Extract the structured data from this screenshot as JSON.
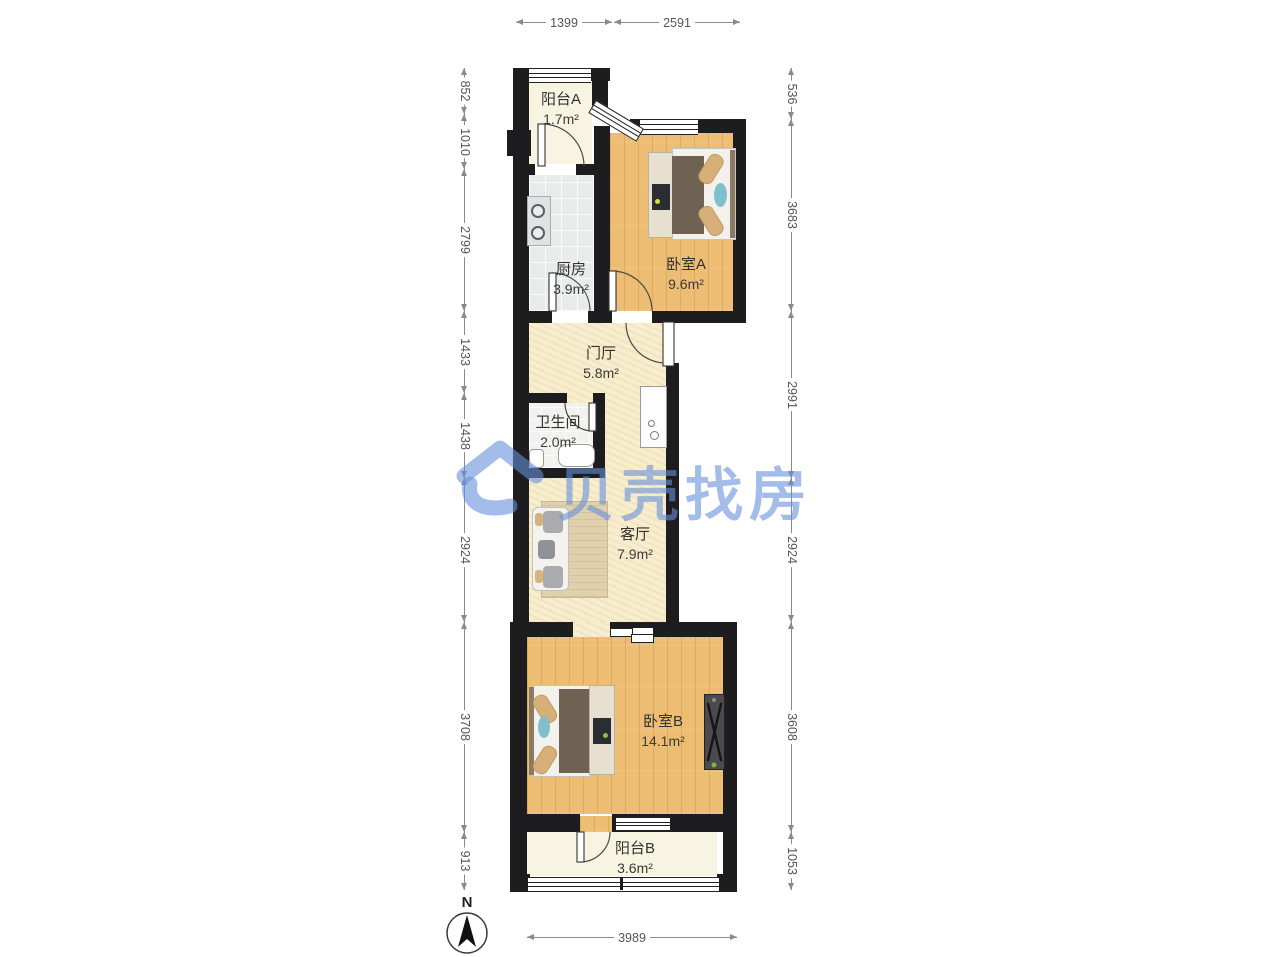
{
  "watermark": {
    "text": "贝壳找房",
    "color": "#6890da"
  },
  "compass": {
    "label": "N"
  },
  "rooms": [
    {
      "id": "balcony-a",
      "name": "阳台A",
      "area": "1.7m²"
    },
    {
      "id": "kitchen",
      "name": "厨房",
      "area": "3.9m²"
    },
    {
      "id": "bedroom-a",
      "name": "卧室A",
      "area": "9.6m²"
    },
    {
      "id": "hall",
      "name": "门厅",
      "area": "5.8m²"
    },
    {
      "id": "bathroom",
      "name": "卫生间",
      "area": "2.0m²"
    },
    {
      "id": "living",
      "name": "客厅",
      "area": "7.9m²"
    },
    {
      "id": "bedroom-b",
      "name": "卧室B",
      "area": "14.1m²"
    },
    {
      "id": "balcony-b",
      "name": "阳台B",
      "area": "3.6m²"
    }
  ],
  "dimensions": {
    "top": [
      "1399",
      "2591"
    ],
    "left": [
      "852",
      "1010",
      "2799",
      "1433",
      "1438",
      "2924",
      "3708",
      "913"
    ],
    "right": [
      "536",
      "3683",
      "2991",
      "2924",
      "3608",
      "1053"
    ],
    "bottom": [
      "3989"
    ]
  },
  "palette": {
    "wall": "#1d1d1f",
    "wood_floor": "#ecbd72",
    "warm_floor": "#f7edcf",
    "balcony_floor": "#f8f4e2",
    "kitchen_tile": "#e9eaea",
    "dimension_text": "#555555",
    "watermark_blue": "#6890da"
  }
}
